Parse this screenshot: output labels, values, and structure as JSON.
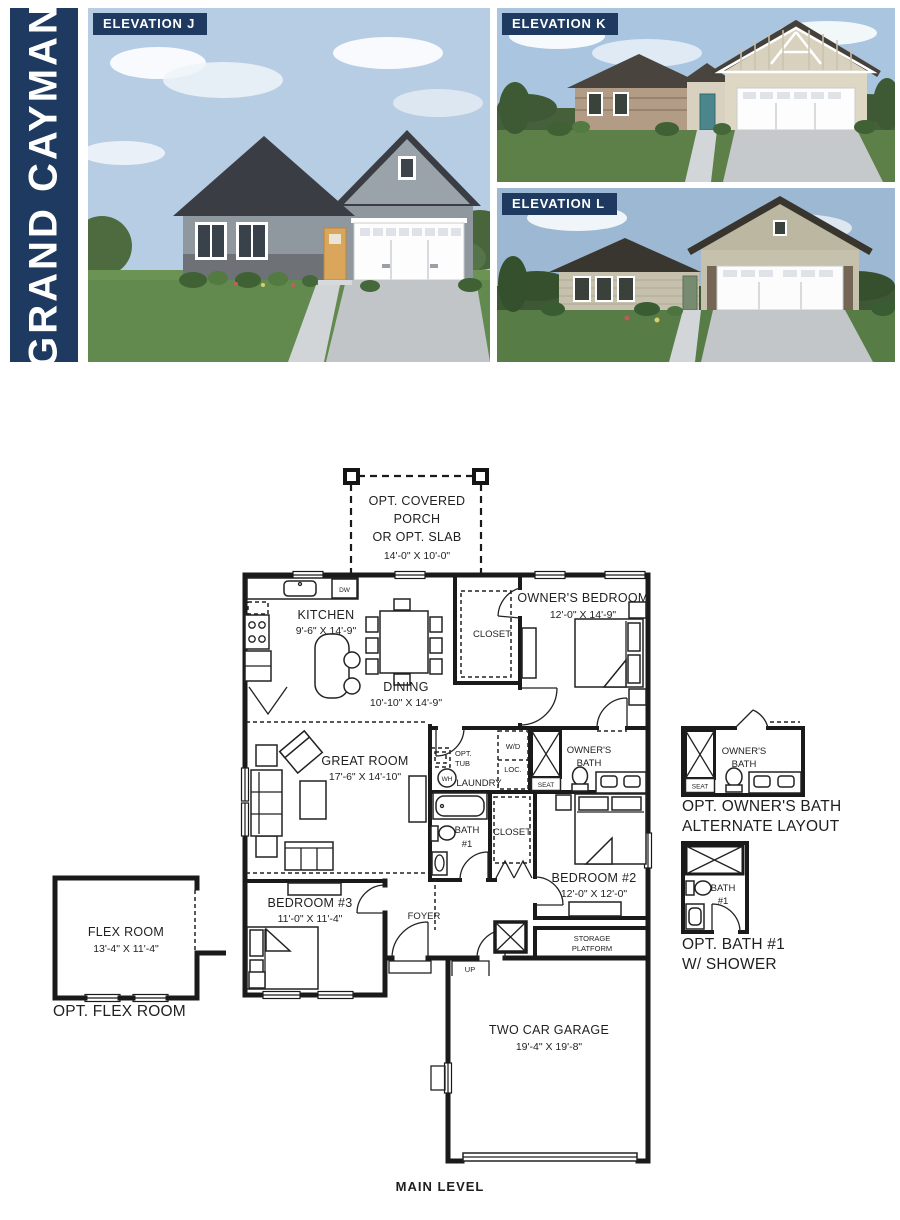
{
  "page": {
    "title": "GRAND CAYMAN",
    "level_label": "MAIN LEVEL"
  },
  "colors": {
    "navy": "#1e3a60",
    "line": "#1a1a1a",
    "white": "#ffffff"
  },
  "elevations": {
    "j": {
      "label": "ELEVATION J"
    },
    "k": {
      "label": "ELEVATION K"
    },
    "l": {
      "label": "ELEVATION L"
    }
  },
  "plan": {
    "porch": {
      "line1": "OPT. COVERED",
      "line2": "PORCH",
      "line3": "OR OPT. SLAB",
      "dims": "14'-0\" X 10'-0\""
    },
    "kitchen": {
      "name": "KITCHEN",
      "dims": "9'-6\" X 14'-9\""
    },
    "dw": "DW",
    "dining": {
      "name": "DINING",
      "dims": "10'-10\" X 14'-9\""
    },
    "owners_bedroom": {
      "name": "OWNER'S BEDROOM",
      "dims": "12'-0\" X 14'-9\""
    },
    "owners_closet": {
      "name": "CLOSET"
    },
    "great_room": {
      "name": "GREAT ROOM",
      "dims": "17'-6\" X 14'-10\""
    },
    "laundry": {
      "name": "LAUNDRY",
      "opt_tub_line1": "OPT.",
      "opt_tub_line2": "TUB",
      "wh": "WH",
      "wd": "W/D",
      "loc": "LOC."
    },
    "owners_bath": {
      "line1": "OWNER'S",
      "line2": "BATH",
      "seat": "SEAT"
    },
    "bath1": {
      "line1": "BATH",
      "line2": "#1"
    },
    "bedroom2": {
      "name": "BEDROOM #2",
      "dims": "12'-0\" X 12'-0\"",
      "closet": "CLOSET"
    },
    "bedroom3": {
      "name": "BEDROOM #3",
      "dims": "11'-0\" X 11'-4\""
    },
    "foyer": {
      "name": "FOYER",
      "up": "UP"
    },
    "storage": {
      "line1": "STORAGE",
      "line2": "PLATFORM"
    },
    "garage": {
      "name": "TWO CAR GARAGE",
      "dims": "19'-4\" X 19'-8\""
    },
    "flex_room": {
      "name": "FLEX ROOM",
      "dims": "13'-4\" X 11'-4\"",
      "caption": "OPT. FLEX ROOM"
    },
    "alt_owners_bath": {
      "line1": "OWNER'S",
      "line2": "BATH",
      "seat": "SEAT",
      "caption1": "OPT. OWNER'S BATH",
      "caption2": "ALTERNATE LAYOUT"
    },
    "opt_bath1": {
      "line1": "BATH",
      "line2": "#1",
      "caption1": "OPT. BATH #1",
      "caption2": "W/ SHOWER"
    }
  }
}
